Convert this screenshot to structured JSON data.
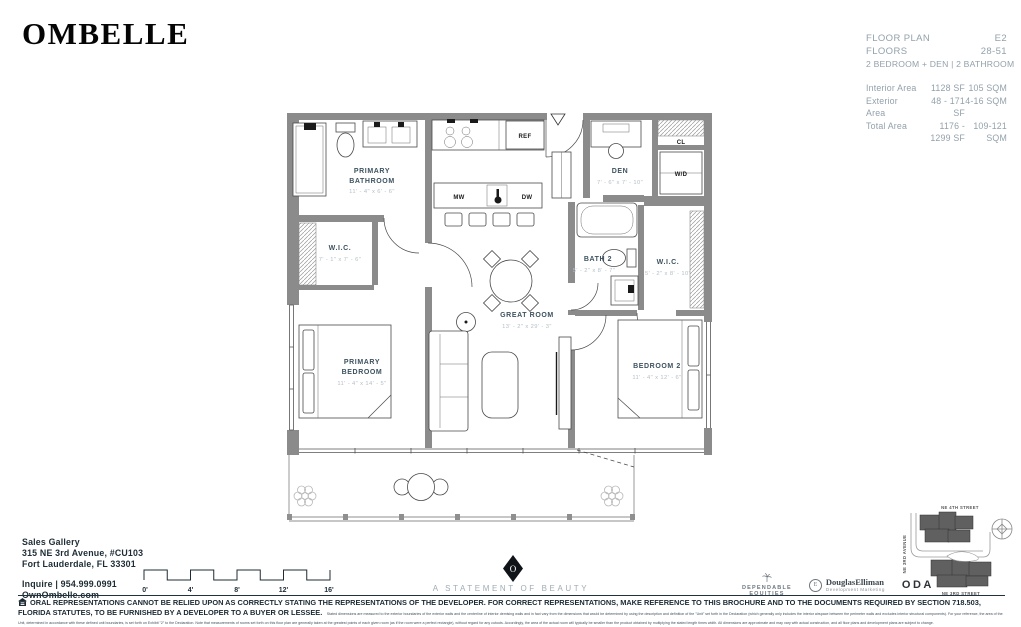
{
  "brand": {
    "logo": "OMBELLE"
  },
  "plan_info": {
    "floor_plan_label": "FLOOR PLAN",
    "floor_plan_value": "E2",
    "floors_label": "FLOORS",
    "floors_value": "28-51",
    "type_line": "2 BEDROOM + DEN | 2 BATHROOM",
    "areas": [
      {
        "label": "Interior Area",
        "sf": "1128 SF",
        "sqm": "105 SQM"
      },
      {
        "label": "Exterior Area",
        "sf": "48 - 171 SF",
        "sqm": "4-16 SQM"
      },
      {
        "label": "Total Area",
        "sf": "1176 - 1299 SF",
        "sqm": "109-121 SQM"
      }
    ]
  },
  "floor_plan": {
    "rooms": {
      "primary_bathroom": {
        "line1": "PRIMARY",
        "line2": "BATHROOM",
        "dims": "11' - 4\" x 6' - 6\""
      },
      "wic_primary": {
        "line1": "W.I.C.",
        "dims": "7' - 1\" x 7' - 6\""
      },
      "primary_bedroom": {
        "line1": "PRIMARY",
        "line2": "BEDROOM",
        "dims": "11' - 4\" x 14' - 5\""
      },
      "great_room": {
        "line1": "GREAT ROOM",
        "dims": "13' - 2\" x 29' - 3\""
      },
      "den": {
        "line1": "DEN",
        "dims": "7' - 6\" x 7' - 10\""
      },
      "bath_2": {
        "line1": "BATH 2",
        "dims": "5' - 2\" x 8' - 7\""
      },
      "wic_2": {
        "line1": "W.I.C.",
        "dims": "5' - 2\" x 8' - 10\""
      },
      "bedroom_2": {
        "line1": "BEDROOM 2",
        "dims": "11' - 4\" x 12' - 6\""
      }
    },
    "appliances": {
      "mw": "MW",
      "dw": "DW",
      "ref": "REF",
      "wd": "W/D",
      "cl": "CL"
    }
  },
  "contact": {
    "title": "Sales Gallery",
    "address_line1": "315 NE 3rd Avenue, #CU103",
    "address_line2": "Fort Lauderdale, FL 33301",
    "inquire": "Inquire  |  954.999.0991",
    "website": "OwnOmbelle.com"
  },
  "scale_bar": {
    "ticks": [
      "0'",
      "4'",
      "8'",
      "12'",
      "16'"
    ]
  },
  "tagline": {
    "medallion_letter": "O",
    "text": "A STATEMENT OF BEAUTY"
  },
  "partners": {
    "dependable_line1": "DEPENDABLE",
    "dependable_line2": "EQUITIES",
    "elliman_initial": "E",
    "elliman_name": "DouglasElliman",
    "elliman_sub": "Development Marketing",
    "oda": "ODA"
  },
  "keyplan": {
    "street_top": "NE 4TH STREET",
    "street_left": "NE 3RD AVENUE",
    "street_bottom": "NE 3RD STREET"
  },
  "disclaimer": {
    "bold": "ORAL REPRESENTATIONS CANNOT BE RELIED UPON AS CORRECTLY STATING THE REPRESENTATIONS OF THE DEVELOPER. FOR CORRECT REPRESENTATIONS, MAKE REFERENCE TO THIS BROCHURE AND TO THE DOCUMENTS REQUIRED BY SECTION 718.503, FLORIDA STATUTES, TO BE FURNISHED BY A DEVELOPER TO A BUYER OR LESSEE.",
    "fine": "Stated dimensions are measured to the exterior boundaries of the exterior walls and the centerline of interior demising walls and in fact vary from the dimensions that would be determined by using the description and definition of the \"Unit\" set forth in the Declaration (which generally only includes the interior airspace between the perimeter walls and excludes interior structural components). For your reference, the area of the Unit, determined in accordance with these defined unit boundaries, is set forth on Exhibit \"2\" to the Declaration. Note that measurements of rooms set forth on this floor plan are generally taken at the greatest points of each given room (as if the room were a perfect rectangle), without regard for any cutouts. Accordingly, the area of the actual room will typically be smaller than the product obtained by multiplying the stated length times width. All dimensions are approximate and may vary with actual construction, and all floor plans and development plans are subject to change."
  }
}
